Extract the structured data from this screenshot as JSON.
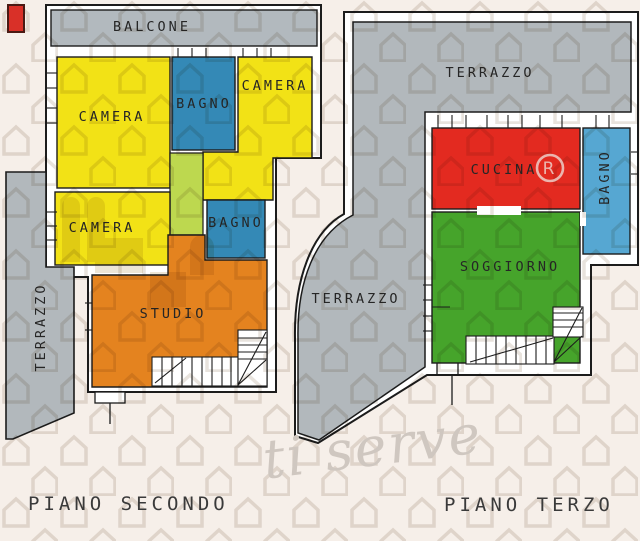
{
  "colors": {
    "background": "#f6efe9",
    "wall_fill": "#ffffff",
    "wall_line": "#1c1c1c",
    "terrace_gray": "#b2b8bc",
    "balcony_gray": "#b2b9be",
    "room_yellow": "#f2e216",
    "bath_blue": "#3489b6",
    "bath_blue_light": "#56a7d2",
    "corridor_green": "#bdd84f",
    "studio_orange": "#e4831f",
    "kitchen_red": "#e32a20",
    "living_green": "#46a42b",
    "watermark_gray": "#d8d0c7",
    "logo_tan": "#dccfb4",
    "red_mark": "#d93028",
    "registered_pink": "#eed8d2"
  },
  "second_floor": {
    "caption": "PIANO SECONDO",
    "rooms": {
      "balcone": "BALCONE",
      "camera_big": "CAMERA",
      "bagno_top": "BAGNO",
      "camera_right": "CAMERA",
      "camera_small": "CAMERA",
      "bagno_mid": "BAGNO",
      "studio": "STUDIO",
      "terrazzo": "TERRAZZO"
    }
  },
  "third_floor": {
    "caption": "PIANO TERZO",
    "rooms": {
      "terrazzo_top": "TERRAZZO",
      "terrazzo_side": "TERRAZZO",
      "cucina": "CUCINA",
      "bagno": "BAGNO",
      "soggiorno": "SOGGIORNO"
    }
  },
  "watermark": {
    "script_text": "ti serve",
    "registered_symbol": "®"
  }
}
